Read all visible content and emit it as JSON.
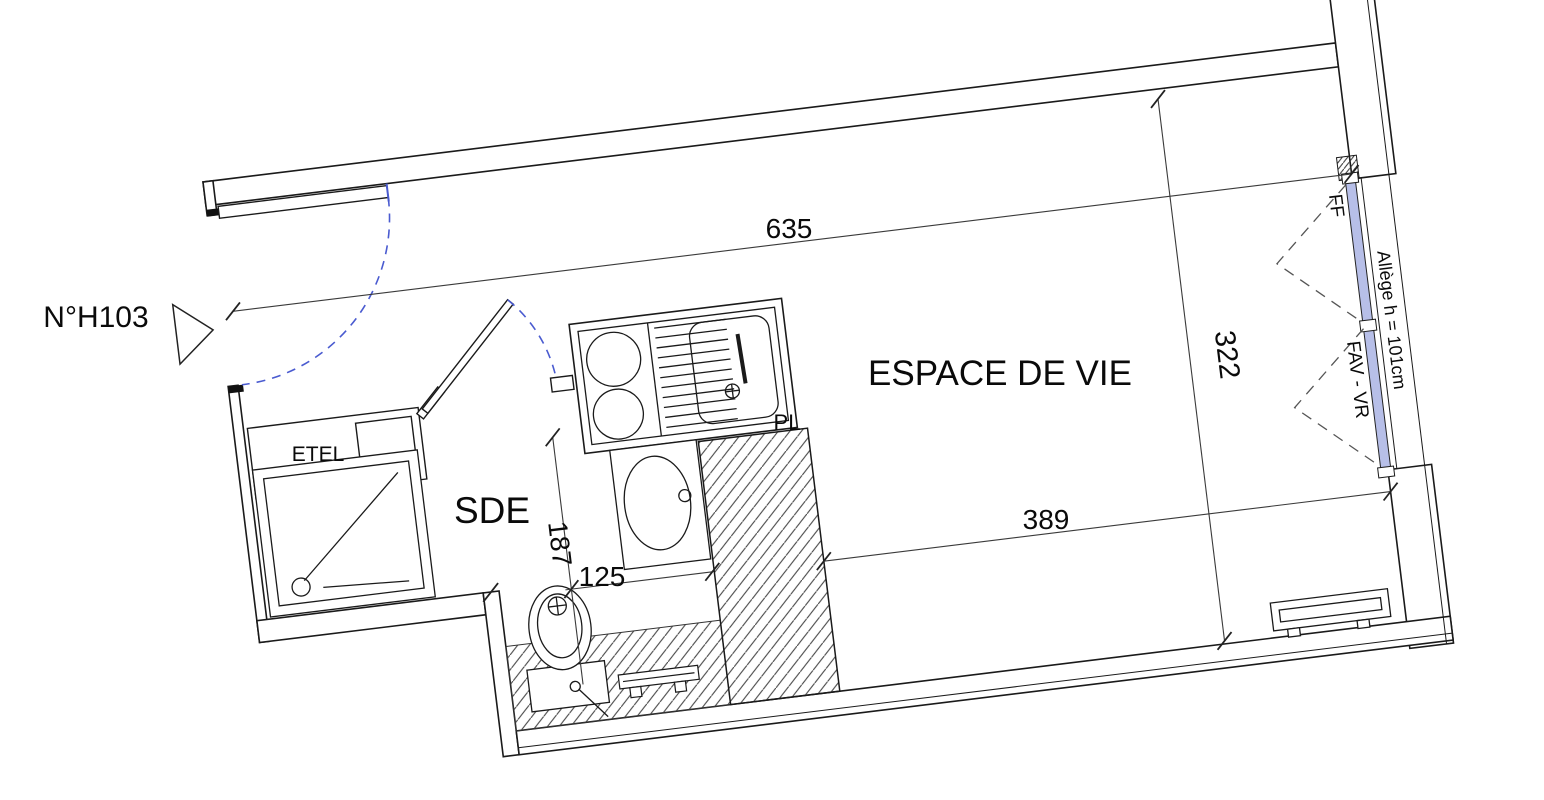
{
  "plan": {
    "unit_label": "N°H103",
    "rooms": {
      "living": "ESPACE DE VIE",
      "bathroom": "SDE"
    },
    "fixtures": {
      "technical_cabinet": "ETEL",
      "closet": "PL"
    },
    "dimensions": {
      "living_top_width": "635",
      "living_height": "322",
      "living_bottom_width": "389",
      "bathroom_depth": "187",
      "bathroom_width": "125"
    },
    "window": {
      "type_label": "FF",
      "sill_label": "Allège h = 101cm",
      "opening_label": "FAV - VR"
    },
    "colors": {
      "line": "#1a1a1a",
      "dimension": "#3a3a3a",
      "door_swing_blue": "#4a5bd0",
      "window_swing_gray": "#555555",
      "glazing_fill": "#b7bfe8",
      "background": "#ffffff"
    }
  }
}
